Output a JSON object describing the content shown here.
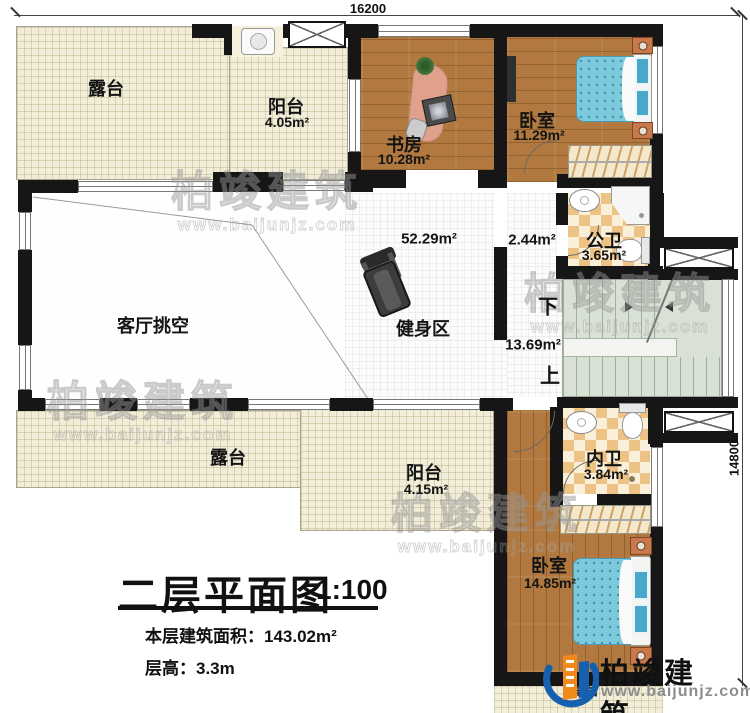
{
  "plan": {
    "dimensions": {
      "width_mm": "16200",
      "height_mm": "14800"
    },
    "rooms": {
      "terrace_top": {
        "name": "露台"
      },
      "balcony_top": {
        "name": "阳台",
        "area": "4.05m²"
      },
      "study": {
        "name": "书房",
        "area": "10.28m²"
      },
      "bedroom_top": {
        "name": "卧室",
        "area": "11.29m²"
      },
      "bath_public": {
        "name": "公卫",
        "area": "3.65m²"
      },
      "hallway": {
        "area": "2.44m²"
      },
      "living_void": {
        "name": "客厅挑空",
        "area": "52.29m²"
      },
      "fitness": {
        "name": "健身区"
      },
      "stairs": {
        "area": "13.69m²",
        "down_label": "下",
        "up_label": "上"
      },
      "terrace_bottom": {
        "name": "露台"
      },
      "balcony_bottom": {
        "name": "阳台",
        "area": "4.15m²"
      },
      "bath_ensuite": {
        "name": "内卫",
        "area": "3.84m²"
      },
      "bedroom_bottom": {
        "name": "卧室",
        "area": "14.85m²"
      },
      "terrace_bottom_right": {
        "name": "露台"
      }
    }
  },
  "title_block": {
    "title": "二层平面图",
    "scale": "1:100",
    "floor_area": "本层建筑面积：143.02m²",
    "floor_height": "层高：3.3m"
  },
  "watermark": {
    "brand": "柏竣建筑",
    "url": "www.baijunjz.com"
  },
  "logo": {
    "brand": "柏竣建筑、",
    "url": "www.baijunjz.com"
  },
  "colors": {
    "wall": "#161616",
    "wood_floor": "#b1793f",
    "terrace_floor": "#f1edd8",
    "bathroom_tile": "#ecc285",
    "stair_floor": "#d9e0d4",
    "bed_blue": "#7ecadd",
    "logo_blue": "#1660b0",
    "logo_orange": "#f08a1d"
  }
}
